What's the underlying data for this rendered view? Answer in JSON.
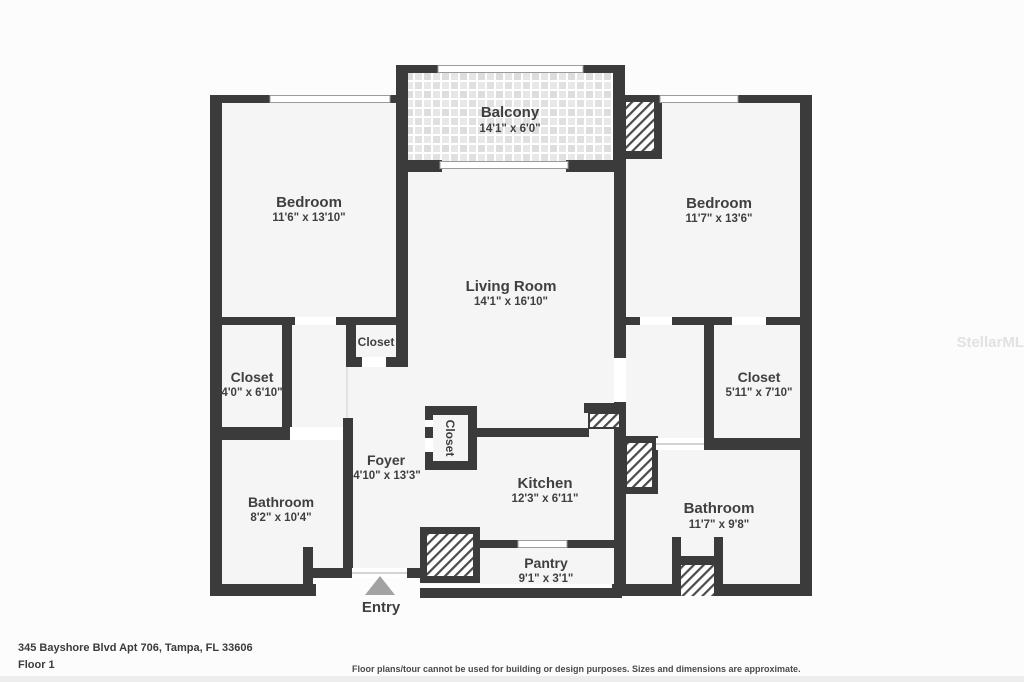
{
  "floorplan": {
    "rooms": {
      "balcony": {
        "name": "Balcony",
        "dims": "14'1\" x 6'0\""
      },
      "bedroom_left": {
        "name": "Bedroom",
        "dims": "11'6\" x 13'10\""
      },
      "bedroom_right": {
        "name": "Bedroom",
        "dims": "11'7\" x 13'6\""
      },
      "living_room": {
        "name": "Living Room",
        "dims": "14'1\" x 16'10\""
      },
      "closet_left": {
        "name": "Closet",
        "dims": "4'0\" x 6'10\""
      },
      "closet_center": {
        "name": "Closet"
      },
      "closet_foyer": {
        "name": "Closet"
      },
      "closet_right": {
        "name": "Closet",
        "dims": "5'11\" x 7'10\""
      },
      "foyer": {
        "name": "Foyer",
        "dims": "4'10\" x 13'3\""
      },
      "kitchen": {
        "name": "Kitchen",
        "dims": "12'3\" x 6'11\""
      },
      "bathroom_left": {
        "name": "Bathroom",
        "dims": "8'2\" x 10'4\""
      },
      "bathroom_right": {
        "name": "Bathroom",
        "dims": "11'7\" x 9'8\""
      },
      "pantry": {
        "name": "Pantry",
        "dims": "9'1\" x 3'1\""
      }
    },
    "entry_label": "Entry",
    "watermark": "StellarMLS"
  },
  "footer": {
    "address": "345 Bayshore Blvd Apt 706, Tampa, FL 33606",
    "floor_label": "Floor 1",
    "disclaimer": "Floor plans/tour cannot be used for building or design purposes. Sizes and dimensions are approximate."
  },
  "colors": {
    "wall": "#3b3b3b",
    "floor": "#f5f5f5",
    "page": "#fcfcfc",
    "window_stroke": "#9b9b9b",
    "entry_arrow": "#a2a2a2",
    "label_text": "#3f3f3f"
  }
}
